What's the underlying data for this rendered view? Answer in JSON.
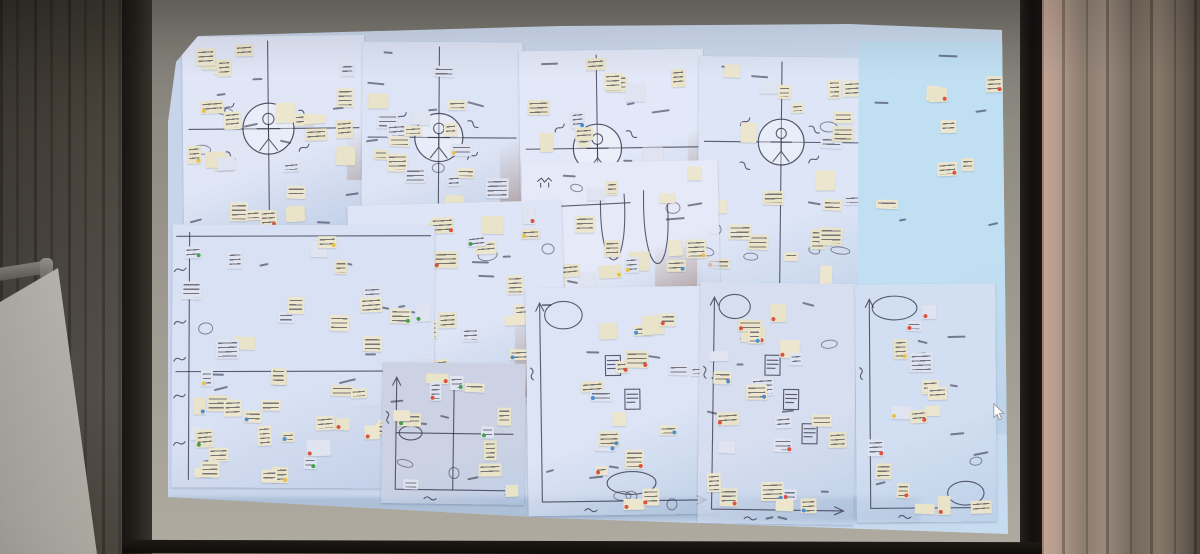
{
  "scene": {
    "description": "Photograph of a dim conference room: a projector screen shows a zoomed-out digital whiteboard covered with overlapping scanned workshop sheets (empathy maps with stick-figure personas, dense sticky-note clusters, journey-map grids and 2x2 prioritization matrices with hand-drawn axes). Tan curtains flank the screen; a flip-chart easel stands at lower left; a white mouse cursor sits near the right screen edge.",
    "palette": {
      "wall": "#5e5d57",
      "curtain_left": "#4b463e",
      "curtain_right_lit": "#c5a496",
      "curtain_right_shadow": "#4f463d",
      "screen_border": "#9a968d",
      "frame_black": "#121010",
      "projection_blue": "#ccd8ec",
      "panel_cyan": "#c0dff2",
      "sheet_white": "#dde4f5",
      "sticky_note": "#e9e3c9",
      "sticky_note_alt": "#dfe4f0",
      "ink": "#32323c",
      "board_gap_brown": "#9c6b50",
      "dot_red": "#d9533f",
      "dot_blue": "#4a8fd4",
      "dot_green": "#43a04f",
      "dot_yellow": "#e6c04e"
    },
    "cursor": {
      "x": 992,
      "y": 403,
      "color": "#ffffff"
    },
    "projection": {
      "board_patches": [
        {
          "x": 347,
          "y": 42,
          "w": 22,
          "h": 138
        },
        {
          "x": 500,
          "y": 95,
          "w": 24,
          "h": 118
        },
        {
          "x": 688,
          "y": 88,
          "w": 14,
          "h": 78
        },
        {
          "x": 515,
          "y": 297,
          "w": 20,
          "h": 100
        },
        {
          "x": 655,
          "y": 247,
          "w": 48,
          "h": 92
        }
      ],
      "sheets": [
        {
          "id": "empathy-1",
          "type": "empathy",
          "x": 183,
          "y": 36,
          "w": 182,
          "h": 197,
          "rot": -0.6,
          "fill": "#e0e6f6",
          "notes": 26,
          "inks": 10,
          "dot_chance": 0.12,
          "dot_colors": [
            "red",
            "yellow",
            "blue"
          ],
          "seed": 3,
          "cx": 0.47,
          "cy": 0.47,
          "r": 0.14
        },
        {
          "id": "empathy-2",
          "type": "empathy",
          "x": 362,
          "y": 42,
          "w": 160,
          "h": 195,
          "rot": 0.4,
          "fill": "#dde4f5",
          "notes": 20,
          "inks": 8,
          "dot_chance": 0.1,
          "dot_colors": [
            "red",
            "yellow"
          ],
          "seed": 10,
          "cx": 0.48,
          "cy": 0.49,
          "r": 0.15
        },
        {
          "id": "empathy-3",
          "type": "empathy",
          "x": 520,
          "y": 50,
          "w": 184,
          "h": 172,
          "rot": -0.8,
          "fill": "#e2e8f7",
          "notes": 18,
          "inks": 8,
          "dot_chance": 0.1,
          "dot_colors": [
            "red",
            "blue"
          ],
          "seed": 17,
          "cx": 0.42,
          "cy": 0.57,
          "r": 0.14
        },
        {
          "id": "empathy-4",
          "type": "empathy",
          "x": 698,
          "y": 57,
          "w": 176,
          "h": 258,
          "rot": 0.6,
          "fill": "#dde5f6",
          "notes": 22,
          "inks": 9,
          "dot_chance": 0.12,
          "dot_colors": [
            "red",
            "yellow"
          ],
          "seed": 24,
          "cx": 0.47,
          "cy": 0.33,
          "r": 0.13
        },
        {
          "id": "cyan-panel",
          "type": "panel",
          "x": 858,
          "y": 42,
          "w": 150,
          "h": 392,
          "rot": 0.2,
          "fill": "#c0dff2",
          "notes": 13,
          "inks": 6,
          "dot_chance": 0.4,
          "dot_colors": [
            "red"
          ],
          "seed": 31,
          "flat": true
        },
        {
          "id": "curves-sheet",
          "type": "curves",
          "x": 523,
          "y": 162,
          "w": 196,
          "h": 146,
          "rot": -1.2,
          "fill": "#e6eaf8",
          "notes": 15,
          "inks": 9,
          "dot_chance": 0.25,
          "dot_colors": [
            "yellow",
            "green",
            "blue"
          ],
          "seed": 38
        },
        {
          "id": "notes-sheet",
          "type": "notes",
          "x": 350,
          "y": 203,
          "w": 214,
          "h": 200,
          "rot": -1.6,
          "fill": "#dee5f6",
          "notes": 26,
          "inks": 10,
          "dot_chance": 0.45,
          "dot_colors": [
            "blue",
            "green",
            "yellow",
            "red"
          ],
          "seed": 45
        },
        {
          "id": "journey-sheet",
          "type": "journey",
          "x": 172,
          "y": 225,
          "w": 262,
          "h": 263,
          "rot": 0.3,
          "fill": "#d9e1f4",
          "notes": 46,
          "inks": 11,
          "dot_chance": 0.3,
          "dot_colors": [
            "blue",
            "green",
            "yellow",
            "red"
          ],
          "seed": 52
        },
        {
          "id": "matrix-1",
          "type": "matrix",
          "x": 382,
          "y": 363,
          "w": 143,
          "h": 141,
          "rot": 0.8,
          "fill": "#ccd2e3",
          "notes": 12,
          "inks": 6,
          "dot_chance": 0.35,
          "dot_colors": [
            "red",
            "yellow",
            "green"
          ],
          "seed": 59,
          "cross": true,
          "ovals": [
            {
              "x": 0.2,
              "y": 0.5,
              "rx": 0.08,
              "ry": 0.05
            }
          ]
        },
        {
          "id": "matrix-2",
          "type": "matrix",
          "x": 527,
          "y": 287,
          "w": 188,
          "h": 228,
          "rot": -0.8,
          "fill": "#dce4f5",
          "notes": 18,
          "inks": 10,
          "dot_chance": 0.5,
          "dot_colors": [
            "red",
            "red",
            "blue"
          ],
          "seed": 66,
          "sketches": 2,
          "ovals": [
            {
              "x": 0.2,
              "y": 0.12,
              "rx": 0.1,
              "ry": 0.06
            },
            {
              "x": 0.55,
              "y": 0.86,
              "rx": 0.13,
              "ry": 0.05
            }
          ]
        },
        {
          "id": "matrix-3",
          "type": "matrix",
          "x": 699,
          "y": 283,
          "w": 156,
          "h": 241,
          "rot": 0.8,
          "fill": "#d7def0",
          "notes": 22,
          "inks": 10,
          "dot_chance": 0.6,
          "dot_colors": [
            "red",
            "red",
            "red",
            "blue"
          ],
          "seed": 73,
          "sketches": 3,
          "ovals": [
            {
              "x": 0.22,
              "y": 0.1,
              "rx": 0.1,
              "ry": 0.05
            }
          ]
        },
        {
          "id": "matrix-4",
          "type": "matrix",
          "x": 856,
          "y": 284,
          "w": 140,
          "h": 238,
          "rot": -0.4,
          "fill": "#d2def1",
          "notes": 15,
          "inks": 8,
          "dot_chance": 0.55,
          "dot_colors": [
            "red",
            "red",
            "yellow"
          ],
          "seed": 80,
          "ovals": [
            {
              "x": 0.28,
              "y": 0.1,
              "rx": 0.16,
              "ry": 0.05
            },
            {
              "x": 0.78,
              "y": 0.88,
              "rx": 0.13,
              "ry": 0.05
            }
          ]
        }
      ]
    }
  }
}
